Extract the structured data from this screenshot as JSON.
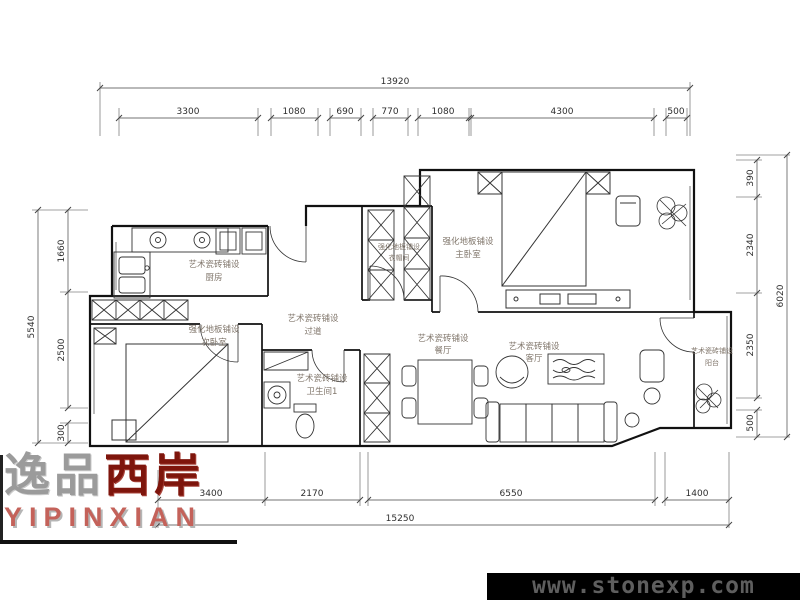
{
  "watermark": {
    "url_text": "www.stonexp.com"
  },
  "logo": {
    "cn_gray": "逸品",
    "cn_red": "西岸",
    "en": "YIPINXIAN"
  },
  "colors": {
    "logo_red": "#7e150c",
    "logo_en_red": "#c4625a",
    "watermark_bg": "#000000",
    "watermark_text": "#5e5e5e",
    "line": "#222222"
  },
  "dims": {
    "top": {
      "overall": "13920",
      "segments": [
        "3300",
        "1080",
        "690",
        "770",
        "1080",
        "4300",
        "500"
      ]
    },
    "bottom": {
      "overall": "15250",
      "segments": [
        "3400",
        "2170",
        "6550",
        "1400"
      ]
    },
    "left": {
      "overall": "5540",
      "segments": [
        "1660",
        "2500",
        "300"
      ]
    },
    "right": {
      "overall": "6020",
      "segments": [
        "390",
        "2340",
        "2350",
        "500"
      ]
    }
  },
  "rooms": {
    "kitchen": {
      "finish": "艺术瓷砖铺设",
      "name": "厨房"
    },
    "master": {
      "finish": "强化地板铺设",
      "name": "主卧室"
    },
    "closet": {
      "finish": "强化地板铺设",
      "name": "衣帽间"
    },
    "hallway": {
      "finish": "艺术瓷砖铺设",
      "name": "过道"
    },
    "bedroom2": {
      "finish": "强化地板铺设",
      "name": "次卧室"
    },
    "bathroom": {
      "finish": "艺术瓷砖铺设",
      "name": "卫生间1"
    },
    "dining": {
      "finish": "艺术瓷砖铺设",
      "name": "餐厅"
    },
    "living": {
      "finish": "艺术瓷砖铺设",
      "name": "客厅"
    },
    "balcony": {
      "finish": "艺术瓷砖铺设",
      "name": "阳台"
    }
  }
}
